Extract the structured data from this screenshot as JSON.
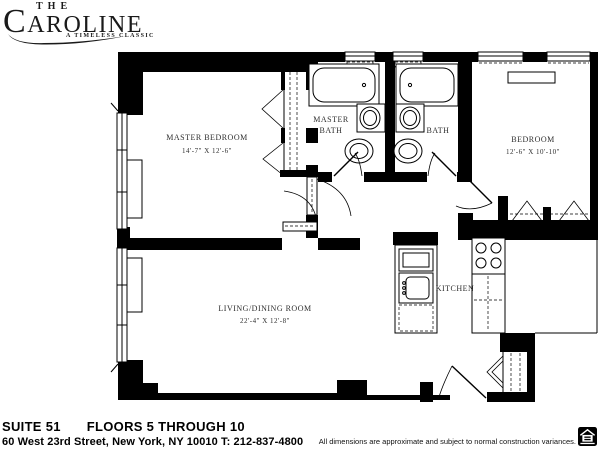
{
  "logo": {
    "the": "THE",
    "name": "CAROLINE",
    "tagline": "A TIMELESS CLASSIC"
  },
  "plan": {
    "labels": {
      "master_bedroom_name": "MASTER BEDROOM",
      "master_bedroom_dims": "14'-7\" X 12'-6\"",
      "master_bath_line1": "MASTER",
      "master_bath_line2": "BATH",
      "bath": "BATH",
      "bedroom_name": "BEDROOM",
      "bedroom_dims": "12'-6\" X 10'-10\"",
      "living_dining_name": "LIVING/DINING ROOM",
      "living_dining_dims": "22'-4\" X 12'-8\"",
      "kitchen": "KITCHEN"
    }
  },
  "footer": {
    "suite": "SUITE 51",
    "floors": "FLOORS 5 THROUGH 10",
    "address": "60 West 23rd Street, New York, NY 10010 T: 212-837-4800",
    "disclaimer": "All dimensions are approximate and subject to normal construction variances."
  }
}
